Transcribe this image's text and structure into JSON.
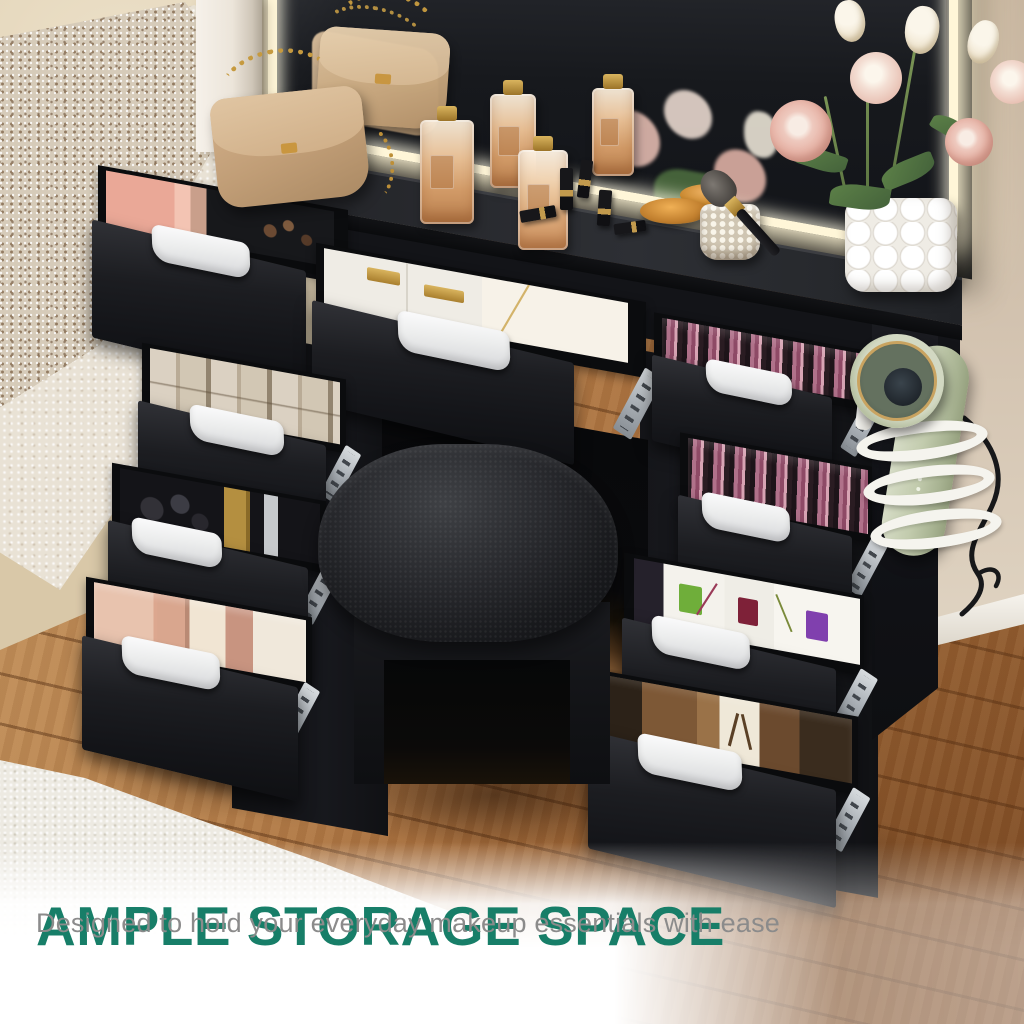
{
  "caption": {
    "headline": "AMPLE STORAGE SPACE",
    "subheadline": "Designed to hold your everyday makeup essentials with ease",
    "headline_color": "#177e68",
    "subheadline_color": "#8b8b8b"
  },
  "palette": {
    "vanity_black": "#1a1b1f",
    "drawer_handle_white": "#eceded",
    "led_strip_warm_white": "#fff6d8",
    "floor_wood_warm": "#b5804a",
    "floor_wood_pale": "#d9c8a8",
    "rug_white": "#edeae2",
    "wall_beige": "#d2c2af",
    "hair_dryer_sage": "#c2cbad",
    "handbag_tan": "#c8a87f",
    "gold_accent": "#c29a4d",
    "stool_leather_black": "#28292d"
  }
}
